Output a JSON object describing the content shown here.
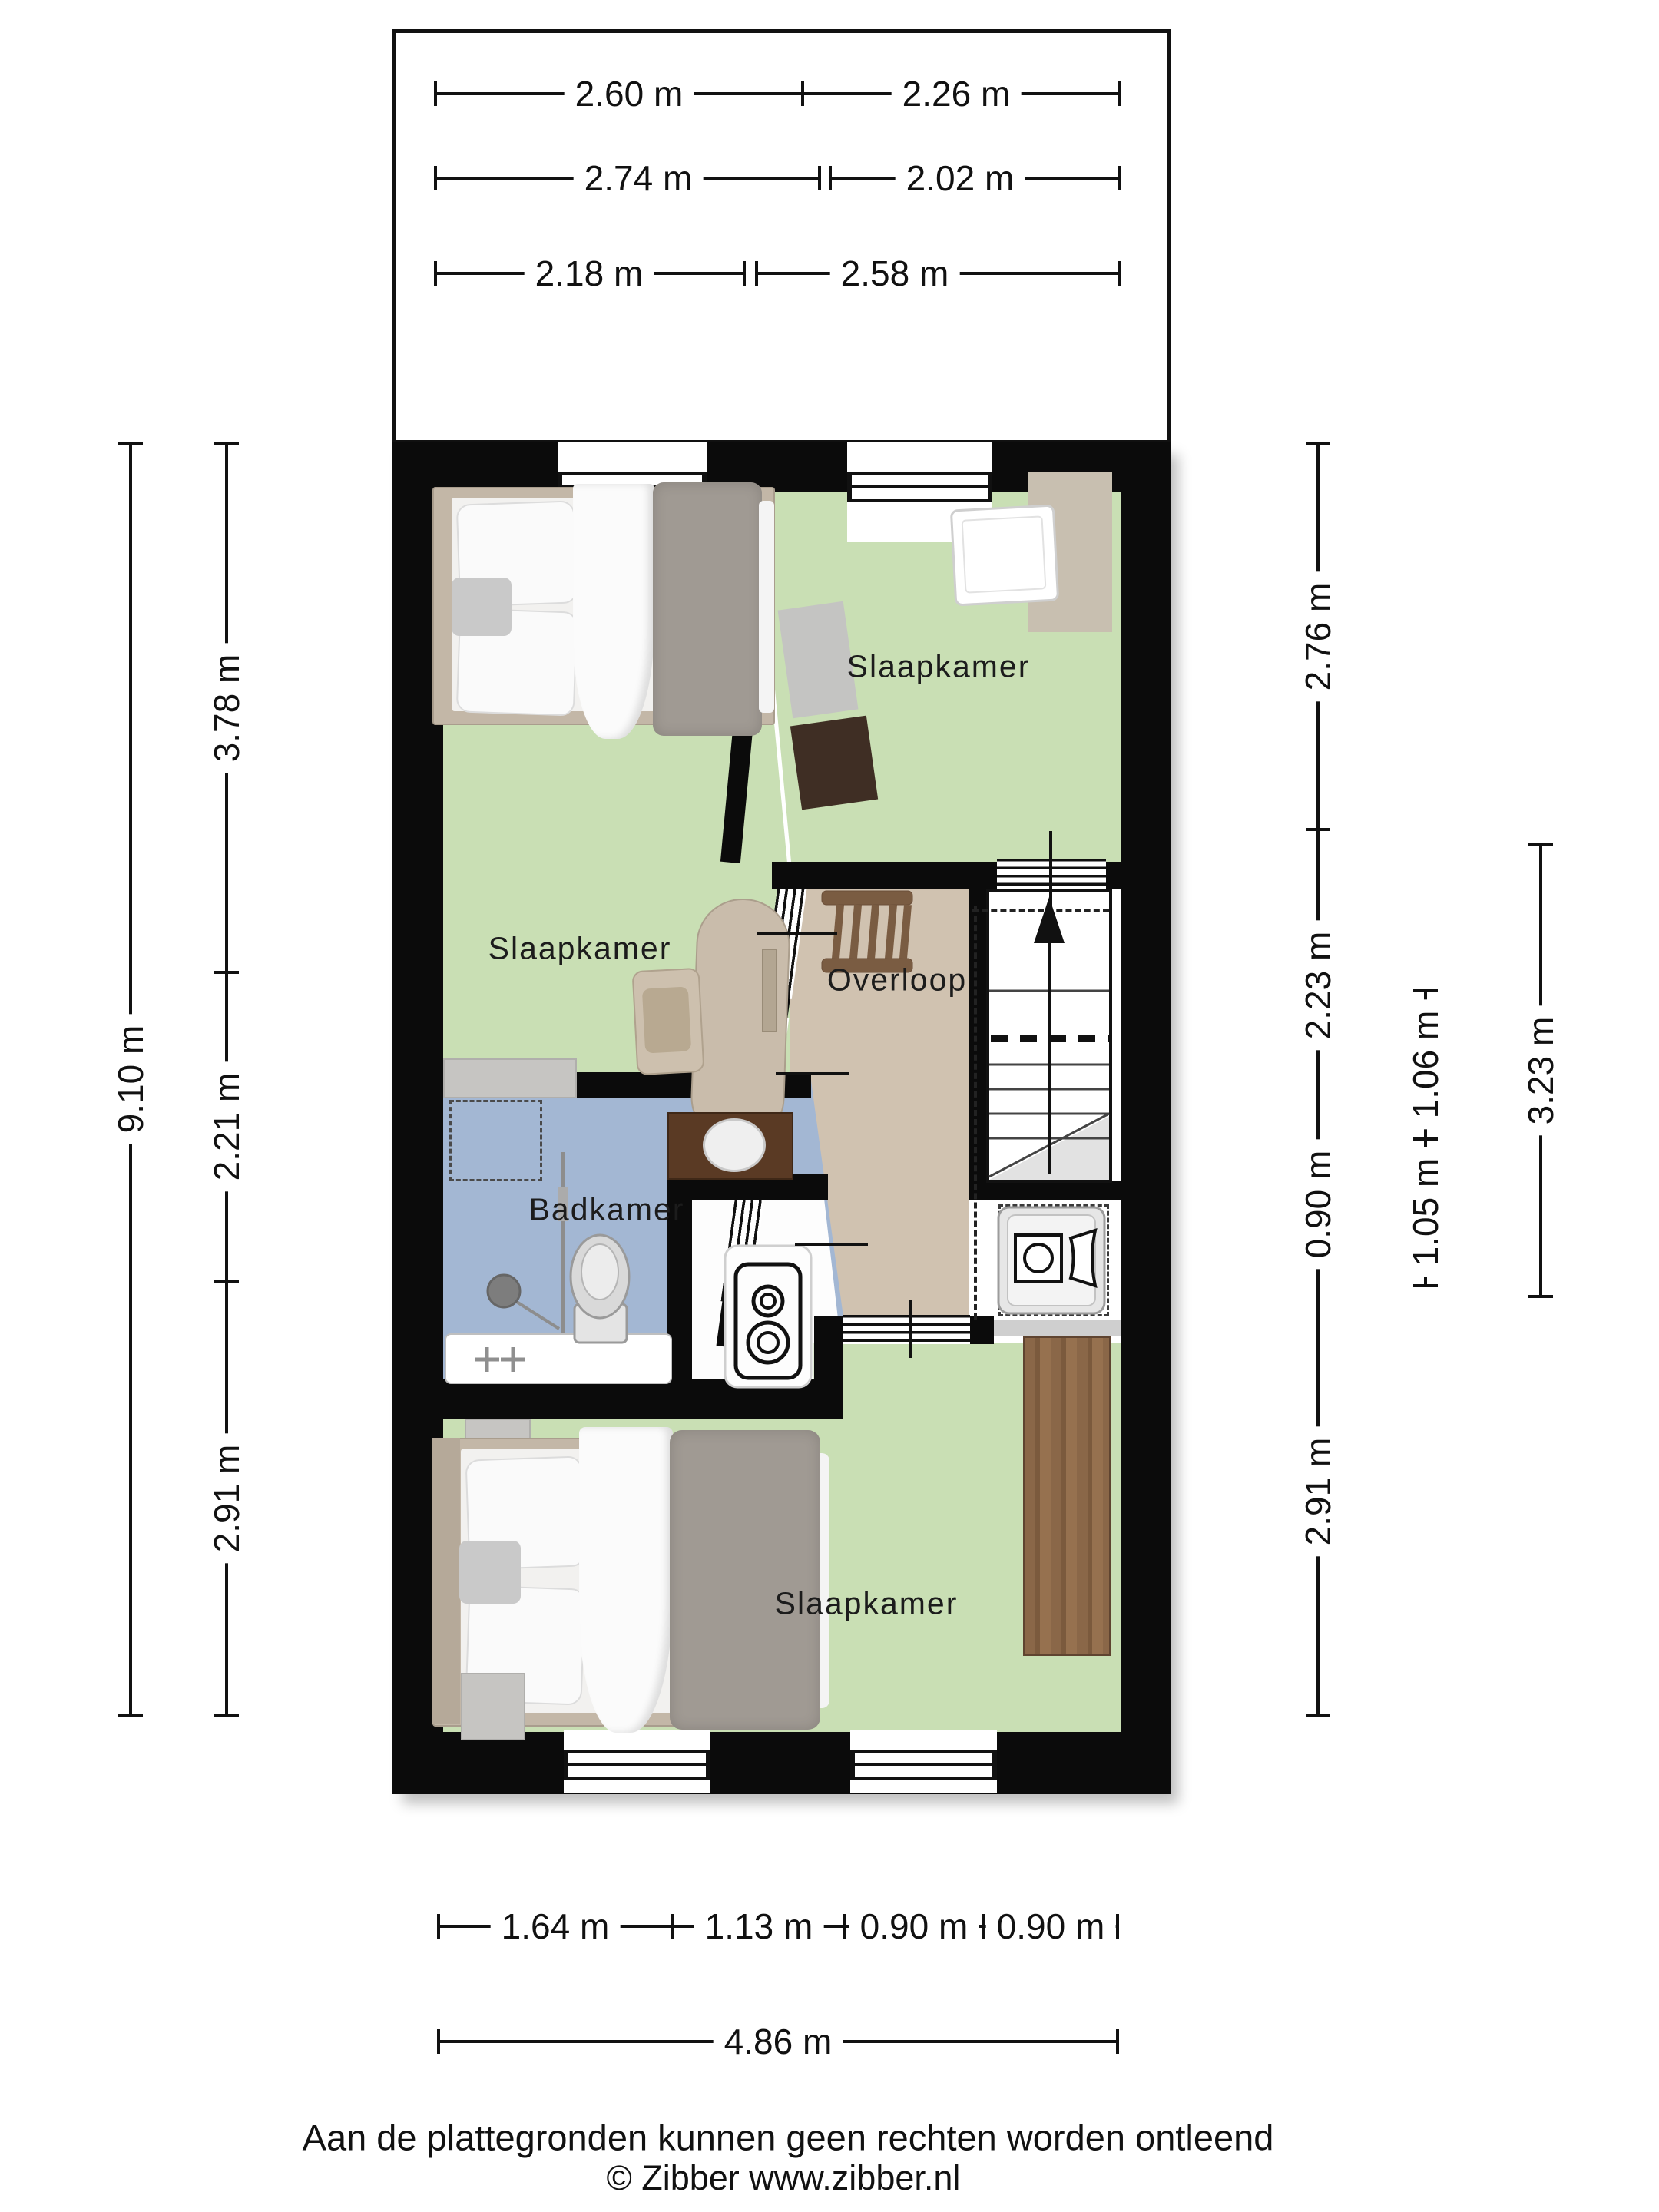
{
  "plan": {
    "floor_name": "verdieping",
    "rooms": {
      "bedroom_top_left": "Slaapkamer",
      "bedroom_top_right": "Slaapkamer",
      "bathroom": "Badkamer",
      "landing": "Overloop",
      "bedroom_bottom": "Slaapkamer"
    },
    "icons": [
      "bed",
      "crib",
      "desk",
      "chair",
      "rug",
      "wardrobe",
      "bathtub",
      "shower",
      "toilet",
      "washbasin",
      "boiler-unit",
      "washing-machine",
      "loft-ladder",
      "staircase-up-arrow",
      "window",
      "door",
      "rooflight-dashes"
    ],
    "colors": {
      "wall": "#0b0b0b",
      "bedroom_floor": "#c9dfb4",
      "bathroom_floor": "#a3b7d3",
      "landing_floor": "#d0c2b0",
      "closet_floor": "#ffffff",
      "wardrobe_wood": "#8a6748",
      "vanity_wood": "#5a3a24",
      "duvet_gray": "#a09a93",
      "frame_tan": "#c3b7a7"
    }
  },
  "dimensions": {
    "top_rows": [
      {
        "left": "2.60 m",
        "right": "2.26 m"
      },
      {
        "left": "2.74 m",
        "right": "2.02 m"
      },
      {
        "left": "2.18 m",
        "right": "2.58 m"
      }
    ],
    "left_outer": "9.10 m",
    "left_inner": [
      "3.78 m",
      "2.21 m",
      "2.91 m"
    ],
    "right_inner": [
      "2.76 m",
      "2.23 m",
      "0.90 m",
      "2.91 m"
    ],
    "right_mid": [
      "1.06 m",
      "1.05 m"
    ],
    "right_outer": "3.23 m",
    "bottom_row": [
      "1.64 m",
      "1.13 m",
      "0.90 m",
      "0.90 m"
    ],
    "bottom_total": "4.86 m"
  },
  "footer": {
    "disclaimer": "Aan de plattegronden kunnen geen rechten worden ontleend",
    "copyright": "© Zibber www.zibber.nl"
  }
}
